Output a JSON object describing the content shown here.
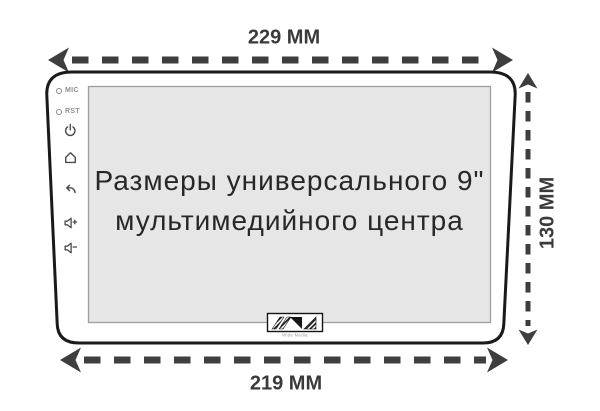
{
  "diagram": {
    "type": "product-dimension-diagram",
    "screen_title": {
      "line1": "Размеры универсального 9\"",
      "line2": "мультимедийного центра"
    },
    "dimensions": {
      "top_width": "229 ММ",
      "side_height": "130 ММ",
      "bottom_width": "219 ММ"
    },
    "side_panel": {
      "mic_label": "MIC",
      "reset_label": "RST",
      "icons": [
        "power-icon",
        "home-icon",
        "back-icon",
        "volume-up-icon",
        "volume-down-icon"
      ]
    },
    "logo": {
      "caption": "Wide Media"
    },
    "colors": {
      "dimension_arrows": "#3e3e3e",
      "device_outline": "#1a1a1a",
      "screen_fill": "#e6e6e6",
      "screen_border": "#9e9e9e",
      "icon_gray": "#4a4a4a",
      "label_gray": "#8f8f8f",
      "background": "#ffffff"
    }
  }
}
